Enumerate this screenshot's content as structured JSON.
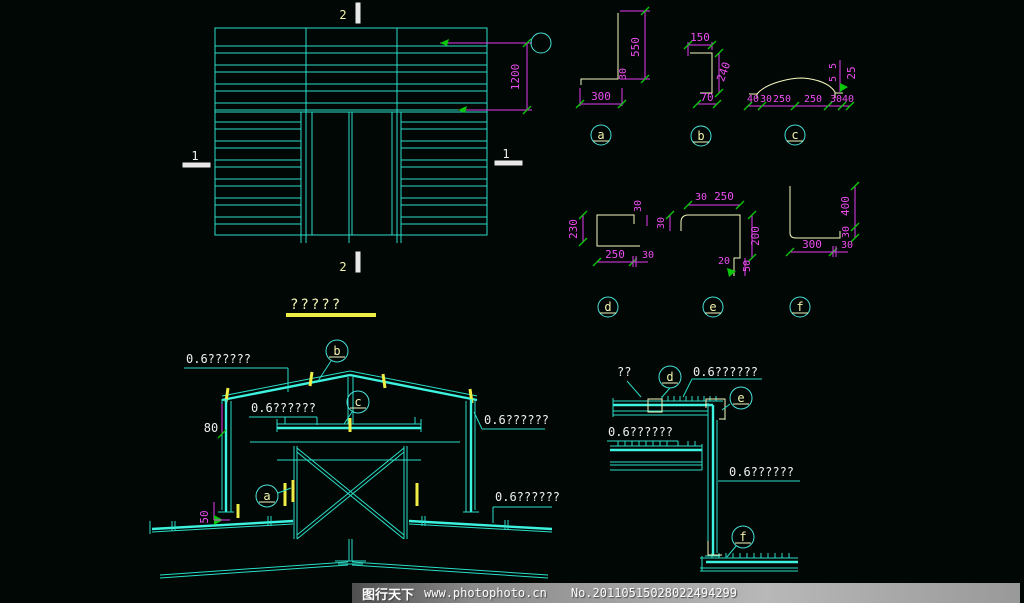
{
  "colors": {
    "background": "#010704",
    "line_cyan": "#2adec8",
    "panel_cyan_bright": "#3df2de",
    "dimension_magenta": "#e43cf0",
    "tick_green": "#0cc70c",
    "profile_yellow": "#f8f8c0",
    "title_underline_yellow": "#f0ee46",
    "text_white": "#efefef",
    "watermark_gray": "#8a8a8a"
  },
  "elevation": {
    "mark_top": "2",
    "mark_bottom": "2",
    "mark_left": "1",
    "mark_right": "1",
    "height_dim": "1200"
  },
  "profiles": {
    "a": {
      "label": "a",
      "v": "550",
      "lip": "30",
      "w": "300"
    },
    "b": {
      "label": "b",
      "top": "150",
      "v": "240",
      "bot": "70"
    },
    "c": {
      "label": "c",
      "b1": "40",
      "b2": "30",
      "b3": "250",
      "b4": "250",
      "b5": "30",
      "b6": "40",
      "r1": "5",
      "r2": "5",
      "r3": "25"
    },
    "d": {
      "label": "d",
      "left": "230",
      "toplip": "30",
      "bot": "250",
      "botlip": "30"
    },
    "e": {
      "label": "e",
      "step": "30",
      "top": "250",
      "leftlip": "30",
      "right": "200",
      "hook": "50",
      "hookw": "20"
    },
    "f": {
      "label": "f",
      "v": "400",
      "vlip": "30",
      "bot": "300",
      "botlip": "30"
    }
  },
  "section": {
    "title": "?????",
    "label_roof_left": "0.6??????",
    "label_inner": "0.6??????",
    "label_right": "0.6??????",
    "label_lower_right": "0.6??????",
    "dim_80": "80",
    "dim_50": "50",
    "callout_a": "a",
    "callout_b": "b",
    "callout_c": "c"
  },
  "eave": {
    "label_unknown": "??",
    "label_top": "0.6??????",
    "label_left": "0.6??????",
    "label_right": "0.6??????",
    "callout_d": "d",
    "callout_e": "e",
    "callout_f": "f"
  },
  "watermark": {
    "brand": "图行天下",
    "url": "www.photophoto.cn",
    "serial": "No.20110515028022494299"
  }
}
